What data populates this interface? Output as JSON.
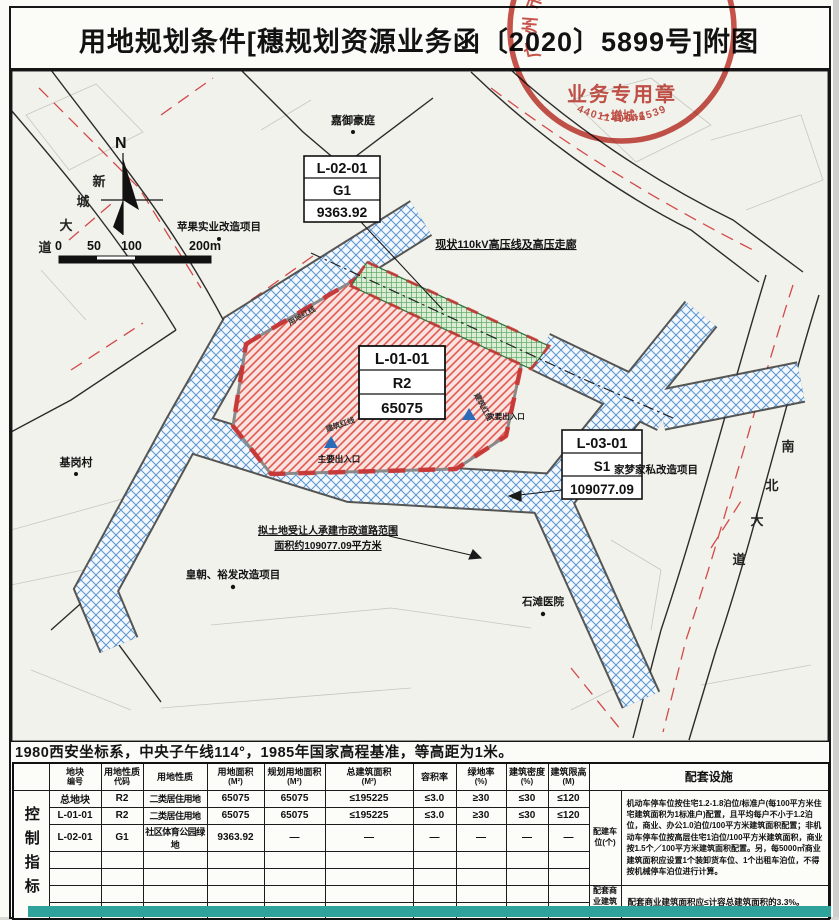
{
  "title": "用地规划条件[穗规划资源业务函〔2020〕5899号]附图",
  "stamp": {
    "ring_text": "广州市规划和自然资源局",
    "center_text": "业务专用章",
    "sub_text": "－增城-1",
    "number": "4401140046539",
    "color": "#c4453c"
  },
  "map": {
    "compass_n": "N",
    "scale": {
      "l0": "0",
      "l50": "50",
      "l100": "100",
      "l200": "200m"
    },
    "parcels": {
      "p1": {
        "code": "L-01-01",
        "type": "R2",
        "area": "65075"
      },
      "p2": {
        "code": "L-02-01",
        "type": "G1",
        "area": "9363.92"
      },
      "p3": {
        "code": "L-03-01",
        "type": "S1",
        "area": "109077.09"
      }
    },
    "labels": {
      "jiayu": "嘉御豪庭",
      "pingguo": "苹果实业改造项目",
      "power": "现状110kV高压线及高压走廊",
      "jigang": "基岗村",
      "main_entrance": "主要出入口",
      "secondary_entrance": "次要出入口",
      "road_note1": "拟土地受让人承建市政道路范围",
      "road_note2": "面积约109077.09平方米",
      "huangchao": "皇朝、裕发改造项目",
      "shitan": "石滩医院",
      "jiameng": "家梦家私改造项目",
      "redline_building": "建筑红线",
      "redline_site": "用地红线",
      "xincheng_chars": [
        "新",
        "城",
        "大",
        "道"
      ],
      "nanbei_chars": [
        "南",
        "北",
        "大",
        "道"
      ]
    },
    "colors": {
      "residential_hatch": "#e05a52",
      "green_hatch": "#3f9e52",
      "road_grid": "#5b94cf",
      "redline": "#cc3030"
    }
  },
  "coord_note": "1980西安坐标系，中央子午线114°，1985年国家高程基准，等高距为1米。",
  "table": {
    "side_label": "控制指标",
    "headers": [
      {
        "t": "地块",
        "u": "编号"
      },
      {
        "t": "用地性质",
        "u": "代码"
      },
      {
        "t": "用地性质",
        "u": ""
      },
      {
        "t": "用地面积",
        "u": "(M²)"
      },
      {
        "t": "规划用地面积",
        "u": "(M²)"
      },
      {
        "t": "总建筑面积",
        "u": "(M²)"
      },
      {
        "t": "容积率",
        "u": ""
      },
      {
        "t": "绿地率",
        "u": "(%)"
      },
      {
        "t": "建筑密度",
        "u": "(%)"
      },
      {
        "t": "建筑限高",
        "u": "(M)"
      },
      {
        "t": "配套设施",
        "u": ""
      }
    ],
    "rows": [
      {
        "cells": [
          "总地块",
          "R2",
          "二类居住用地",
          "65075",
          "65075",
          "≤195225",
          "≤3.0",
          "≥30",
          "≤30",
          "≤120"
        ]
      },
      {
        "cells": [
          "L-01-01",
          "R2",
          "二类居住用地",
          "65075",
          "65075",
          "≤195225",
          "≤3.0",
          "≥30",
          "≤30",
          "≤120"
        ]
      },
      {
        "cells": [
          "L-02-01",
          "G1",
          "社区体育公园绿地",
          "9363.92",
          "—",
          "—",
          "—",
          "—",
          "—",
          "—"
        ]
      },
      {
        "cells": [
          "",
          "",
          "",
          "",
          "",
          "",
          "",
          "",
          "",
          ""
        ]
      },
      {
        "cells": [
          "",
          "",
          "",
          "",
          "",
          "",
          "",
          "",
          "",
          ""
        ]
      },
      {
        "cells": [
          "",
          "",
          "",
          "",
          "",
          "",
          "",
          "",
          "",
          ""
        ]
      },
      {
        "cells": [
          "",
          "",
          "",
          "",
          "",
          "",
          "",
          "",
          "",
          ""
        ]
      }
    ],
    "amenities": {
      "parking_label": "配建车位(个)",
      "parking_text": "机动车停车位按住宅1.2-1.8泊位/标准户(每100平方米住宅建筑面积为1标准户)配置，且平均每户不小于1.2泊位，商业、办公1.0泊位/100平方米建筑面积配置；非机动车停车位按高层住宅1泊位/100平方米建筑面积，商业按1.5个／100平方米建筑面积配置。另，每5000㎡商业建筑面积应设置1个装卸货车位、1个出租车泊位，不得按机械停车泊位进行计算。",
      "commercial_label": "配套商业建筑面积",
      "commercial_text": "配套商业建筑面积应≤计容总建筑面积的3.3%。"
    }
  }
}
